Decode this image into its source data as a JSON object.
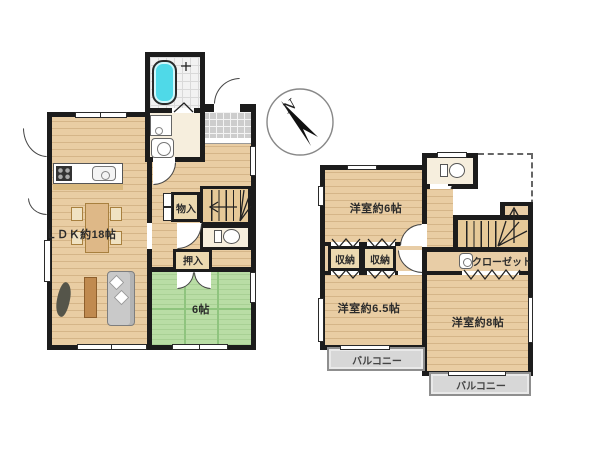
{
  "compass": {
    "north": "N"
  },
  "floor1": {
    "ldk": "ＬＤＫ約18帖",
    "monoire": "物入",
    "oshiire": "押入",
    "tatami": "6帖"
  },
  "floor2": {
    "room6": "洋室約6帖",
    "storage1": "収納",
    "storage2": "収納",
    "closet": "クローゼット",
    "room65": "洋室約6.5帖",
    "room8": "洋室約8帖",
    "balcony1": "バルコニー",
    "balcony2": "バルコニー"
  },
  "colors": {
    "wall": "#1c1c1c",
    "wood_floor": "#e9cda3",
    "tatami_green": "#b9dda5",
    "bathtub_cyan": "#4fd9e8",
    "balcony_gray": "#d7d7d7",
    "genkan_tile": "#cdcdcd",
    "wet_area_cream": "#f6eedd"
  }
}
